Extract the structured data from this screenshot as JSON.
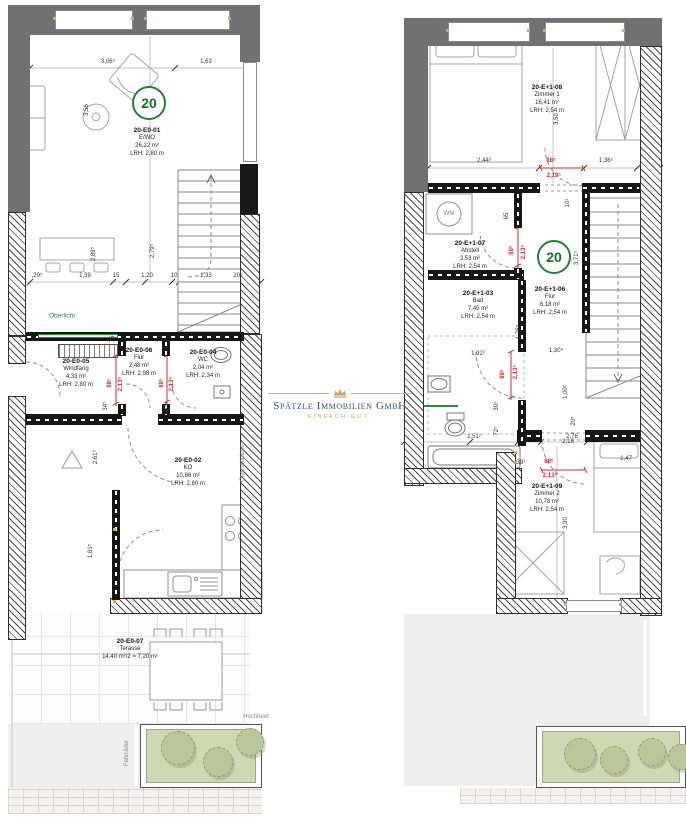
{
  "logo": {
    "company": "Spätzle Immobilien GmbH",
    "tagline": "EINFACH GUT.",
    "navy": "#3d4e60",
    "gold": "#c3a566"
  },
  "badges": {
    "left": "20",
    "right": "20"
  },
  "wm_label": "WM",
  "colors": {
    "wall_gray": "#717171",
    "dim_red": "#d12f2f",
    "badge_green": "#1f8038",
    "oberlicht_green": "#2e8b3c",
    "hochbeet_green": "#cfd8b2"
  },
  "plans": {
    "left": {
      "rooms": [
        {
          "x": 147,
          "y": 127,
          "lines": [
            "20-E0-01",
            "E/WO",
            "26,22 m²",
            "LRH: 2,80 m"
          ]
        },
        {
          "x": 76,
          "y": 358,
          "lines": [
            "20-E0-05",
            "Windfang",
            "4,33 m²",
            "LRH: 2,80 m"
          ]
        },
        {
          "x": 139,
          "y": 347,
          "lines": [
            "20-E0-06",
            "Flur",
            "2,48 m²",
            "LRH: 2,98 m"
          ]
        },
        {
          "x": 203,
          "y": 349,
          "lines": [
            "20-E0-04",
            "WC",
            "2,04 m²",
            "LRH: 2,34 m"
          ]
        },
        {
          "x": 188,
          "y": 457,
          "lines": [
            "20-E0-02",
            "KO",
            "10,86 m²",
            "LRH: 2,80 m"
          ]
        },
        {
          "x": 130,
          "y": 638,
          "lines": [
            "20-E0-07",
            "Terasse",
            "14,40 m²/2 = 7,20 m²"
          ]
        }
      ],
      "dims": [
        {
          "t": "3,06⁵",
          "x": 108,
          "y": 62
        },
        {
          "t": "1,63",
          "x": 206,
          "y": 62
        },
        {
          "t": "3,56",
          "x": 87,
          "y": 110,
          "r": 1
        },
        {
          "t": "2,89⁵",
          "x": 94,
          "y": 254,
          "r": 1
        },
        {
          "t": "2,79⁵",
          "x": 153,
          "y": 251,
          "r": 1
        },
        {
          "t": ",20⁵",
          "x": 37,
          "y": 276
        },
        {
          "t": "1,39",
          "x": 85,
          "y": 276
        },
        {
          "t": "15",
          "x": 116,
          "y": 276
        },
        {
          "t": "1,20",
          "x": 147,
          "y": 276
        },
        {
          "t": "10",
          "x": 174,
          "y": 276
        },
        {
          "t": "1,33",
          "x": 206,
          "y": 276
        },
        {
          "t": "20⁵",
          "x": 238,
          "y": 276
        },
        {
          "t": "75",
          "x": 113,
          "y": 339,
          "r": 1
        },
        {
          "t": "75",
          "x": 161,
          "y": 339,
          "r": 1
        },
        {
          "t": "34⁵",
          "x": 106,
          "y": 406,
          "r": 1
        },
        {
          "t": "34⁵",
          "x": 168,
          "y": 406,
          "r": 1
        },
        {
          "t": "2,61⁵",
          "x": 96,
          "y": 457,
          "r": 1
        },
        {
          "t": "1,81⁵",
          "x": 91,
          "y": 551,
          "r": 1
        },
        {
          "t": "88⁵",
          "x": 110,
          "y": 383,
          "r": 1,
          "c": 1
        },
        {
          "t": "2,13⁵",
          "x": 121,
          "y": 384,
          "r": 1,
          "c": 1
        },
        {
          "t": "88⁵",
          "x": 162,
          "y": 383,
          "r": 1,
          "c": 1
        },
        {
          "t": "2,13⁵",
          "x": 172,
          "y": 384,
          "r": 1,
          "c": 1
        }
      ],
      "notes": [
        {
          "t": "Oberlicht",
          "x": 62,
          "y": 316,
          "cl": "green"
        },
        {
          "t": "Oberschränke",
          "x": 243,
          "y": 463,
          "r": 1
        },
        {
          "t": "Fahrräder",
          "x": 127,
          "y": 753,
          "r": 1
        },
        {
          "t": "Hochbeet",
          "x": 256,
          "y": 717
        }
      ]
    },
    "right": {
      "rooms": [
        {
          "x": 547,
          "y": 84,
          "lines": [
            "20-E+1-08",
            "Zimmer 1",
            "16,41 m²",
            "LRH: 2,54 m"
          ]
        },
        {
          "x": 470,
          "y": 240,
          "lines": [
            "20-E+1-07",
            "Abstell",
            "3,53 m²",
            "LRH: 2,54 m"
          ]
        },
        {
          "x": 550,
          "y": 286,
          "lines": [
            "20-E+1-06",
            "Flur",
            "6,18 m²",
            "LRH: 2,54 m"
          ]
        },
        {
          "x": 478,
          "y": 290,
          "lines": [
            "20-E+1-03",
            "Bad",
            "7,45 m²",
            "LRH: 2,54 m"
          ]
        },
        {
          "x": 547,
          "y": 483,
          "lines": [
            "20-E+1-09",
            "Zimmer 2",
            "10,78 m²",
            "LRH: 2,54 m"
          ]
        }
      ],
      "dims": [
        {
          "t": "2,44³",
          "x": 484,
          "y": 161
        },
        {
          "t": "1,36⁵",
          "x": 606,
          "y": 161
        },
        {
          "t": "3,50",
          "x": 557,
          "y": 119,
          "r": 1
        },
        {
          "t": "10¹",
          "x": 568,
          "y": 203,
          "r": 1
        },
        {
          "t": "65",
          "x": 507,
          "y": 216,
          "r": 1
        },
        {
          "t": "3,71⁵",
          "x": 577,
          "y": 258,
          "r": 1
        },
        {
          "t": "1,92²",
          "x": 478,
          "y": 354
        },
        {
          "t": "1,76⁵",
          "x": 519,
          "y": 332,
          "r": 1
        },
        {
          "t": "1,30⁵",
          "x": 556,
          "y": 351
        },
        {
          "t": "39⁵",
          "x": 497,
          "y": 406,
          "r": 1
        },
        {
          "t": "72⁵",
          "x": 497,
          "y": 431,
          "r": 1
        },
        {
          "t": "1,00¹",
          "x": 566,
          "y": 392,
          "r": 1
        },
        {
          "t": "20⁵",
          "x": 574,
          "y": 421,
          "r": 1
        },
        {
          "t": "1,51²",
          "x": 474,
          "y": 437
        },
        {
          "t": "2,76",
          "x": 572,
          "y": 437
        },
        {
          "t": ",39¹",
          "x": 520,
          "y": 463
        },
        {
          "t": "1,47",
          "x": 626,
          "y": 459
        },
        {
          "t": "2,16",
          "x": 568,
          "y": 442
        },
        {
          "t": "3,90",
          "x": 566,
          "y": 523,
          "r": 1
        },
        {
          "t": "88⁵",
          "x": 551,
          "y": 161,
          "c": 1
        },
        {
          "t": "2,13⁵",
          "x": 554,
          "y": 176,
          "c": 1
        },
        {
          "t": "88⁵",
          "x": 512,
          "y": 250,
          "r": 1,
          "c": 1
        },
        {
          "t": "2,13⁵",
          "x": 524,
          "y": 252,
          "r": 1,
          "c": 1
        },
        {
          "t": "88⁵",
          "x": 503,
          "y": 374,
          "r": 1,
          "c": 1
        },
        {
          "t": "2,13⁵",
          "x": 516,
          "y": 372,
          "r": 1,
          "c": 1
        },
        {
          "t": "88⁵",
          "x": 549,
          "y": 462,
          "c": 1
        },
        {
          "t": "2,13⁵",
          "x": 550,
          "y": 476,
          "c": 1
        }
      ],
      "notes": []
    }
  }
}
